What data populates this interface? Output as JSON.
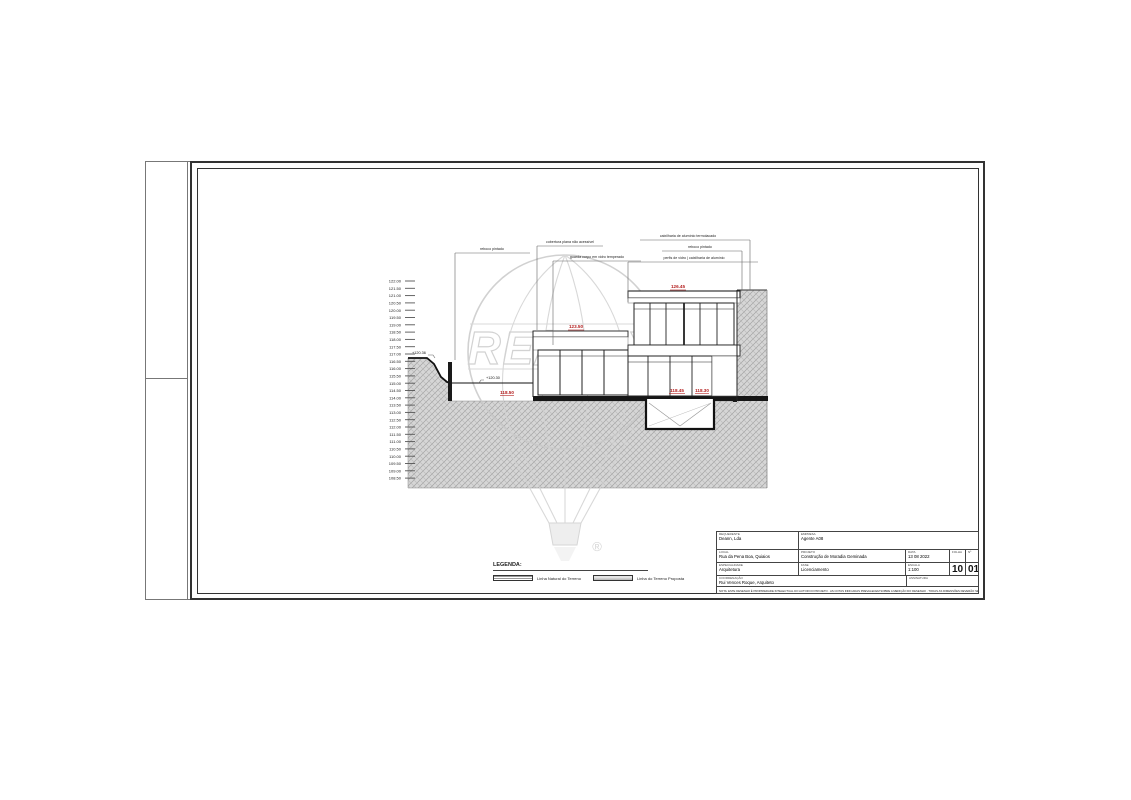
{
  "legend": {
    "title": "LEGENDA:",
    "item_natural": "Linha Natural do Terreno",
    "item_proposed": "Linha do Terreno Proposta"
  },
  "title_block": {
    "requerente_label": "REQUERENTE",
    "requerente": "Deann, Lda",
    "empresa_label": "EMPRESA",
    "empresa": "Agente A08",
    "local_label": "LOCAL",
    "local": "Rua da Pena Boa, Quiaios",
    "projeto_label": "PROJETO",
    "projeto": "Construção de Moradia Geminada",
    "data_label": "DATA",
    "data": "13 08 2022",
    "folha_label": "FOLHA",
    "folha": "10",
    "num_label": "Nº",
    "num": "01",
    "especialidade_label": "ESPECIALIDADE",
    "especialidade": "Arquitetura",
    "fase_label": "FASE",
    "fase": "Licenciamento",
    "escala_label": "ESCALA",
    "escala": "1:100",
    "coordenacao_label": "COORDENAÇÃO",
    "coordenacao": "Rui Vences Roque, Arquiteto",
    "assinatura_label": "ASSINATURA",
    "disclaimer": "NOTA: ESTE DESENHO É PROPRIEDADE INTELECTUAL DO AUTOR DO PROJETO · AS COTAS INDICADAS PREVALECEM SOBRE A MEDIÇÃO DO DESENHO · TODAS AS DIMENSÕES DEVERÃO SER VERIFICADAS EM OBRA"
  },
  "drawing": {
    "elevation_scale": [
      "122.00",
      "121.50",
      "121.00",
      "120.50",
      "120.00",
      "119.50",
      "119.00",
      "118.50",
      "118.00",
      "117.50",
      "117.00",
      "116.50",
      "116.00",
      "115.50",
      "115.00",
      "114.50",
      "114.00",
      "113.50",
      "113.00",
      "112.50",
      "112.00",
      "111.50",
      "111.00",
      "110.50",
      "110.00",
      "109.50",
      "109.00",
      "108.50"
    ],
    "levels": {
      "roof_top": "126.45",
      "lower_roof": "123.50",
      "terrace": "118.50",
      "floor_a": "118.45",
      "floor_b": "118.30",
      "natural_ground": "+120.36",
      "proposed_ground": "+120.30"
    },
    "callouts": {
      "a": "reboco pintado",
      "b": "cobertura plana não acessível",
      "c": "guarda corpo em vidro temperado",
      "d": "caixilharia de alumínio termolacado",
      "e": "reboco pintado",
      "f": "perfis de vidro | caixilharia de alumínio"
    },
    "watermark": {
      "brand": "RE/MAX",
      "registered": "®"
    }
  }
}
